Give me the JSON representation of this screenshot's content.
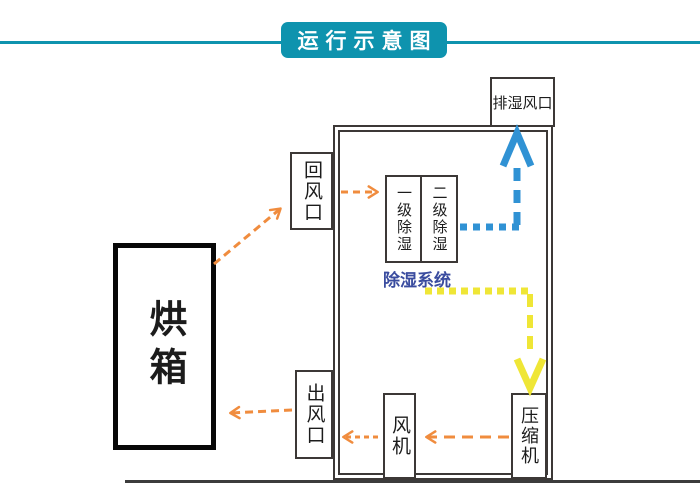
{
  "banner": {
    "title": "运行示意图"
  },
  "colors": {
    "teal": "#0e93ae",
    "orange": "#f08c3e",
    "blue": "#3092d4",
    "yellow": "#efe636",
    "system_label_blue": "#3a4c9f",
    "line_gray": "#3c3836"
  },
  "diagram": {
    "oven_label": "烘箱",
    "return_vent_label": "回风口",
    "outlet_vent_label": "出风口",
    "exhaust_vent_label": "排湿风口",
    "dehumid_stage1_label": "一级除湿",
    "dehumid_stage2_label": "二级除湿",
    "dehumid_system_label": "除湿系统",
    "fan_label": "风机",
    "compressor_label": "压缩机"
  }
}
